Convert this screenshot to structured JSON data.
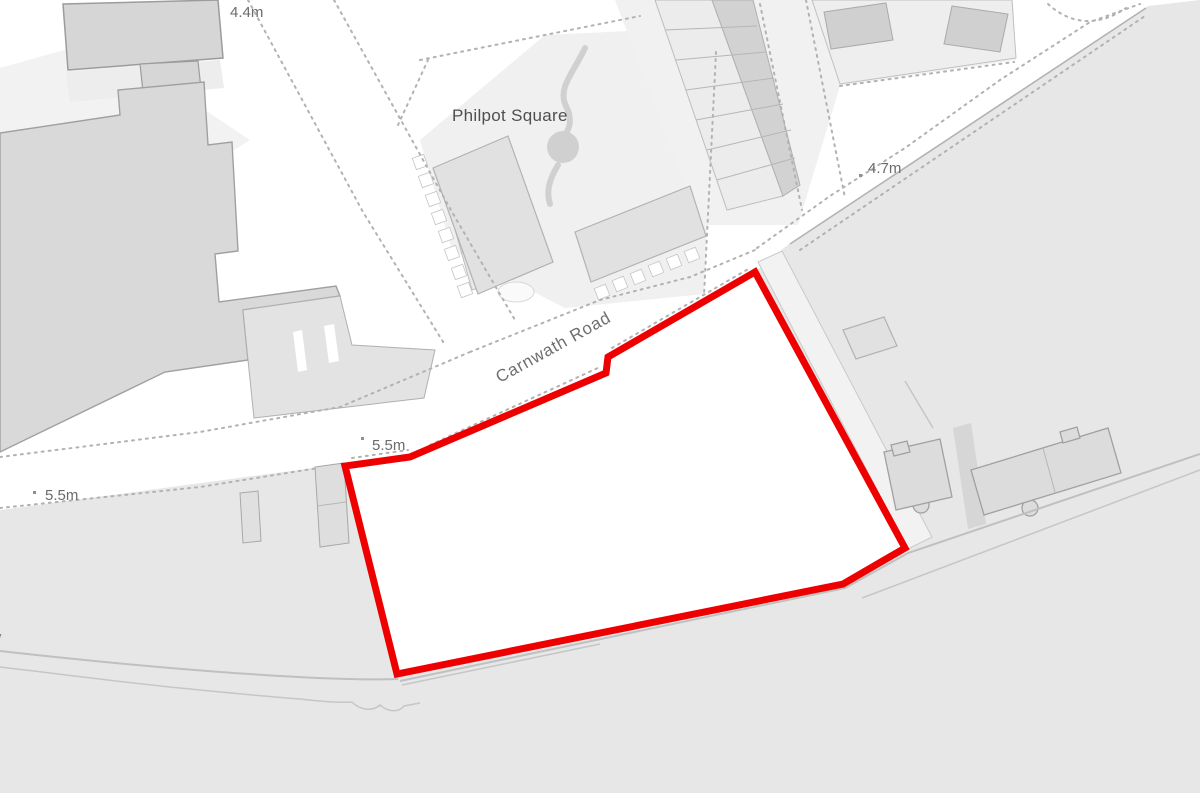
{
  "map": {
    "labels": {
      "place_name": "Philpot Square",
      "road_name": "Carnwath Road",
      "spot_heights": [
        "4.4m",
        "4.7m",
        "5.5m",
        "5.5m"
      ],
      "edge_fragment": "y"
    },
    "colors": {
      "site_boundary": "#ee0000",
      "land": "#e7e7e7",
      "background": "#ffffff",
      "building": "#d8d8d8"
    }
  }
}
